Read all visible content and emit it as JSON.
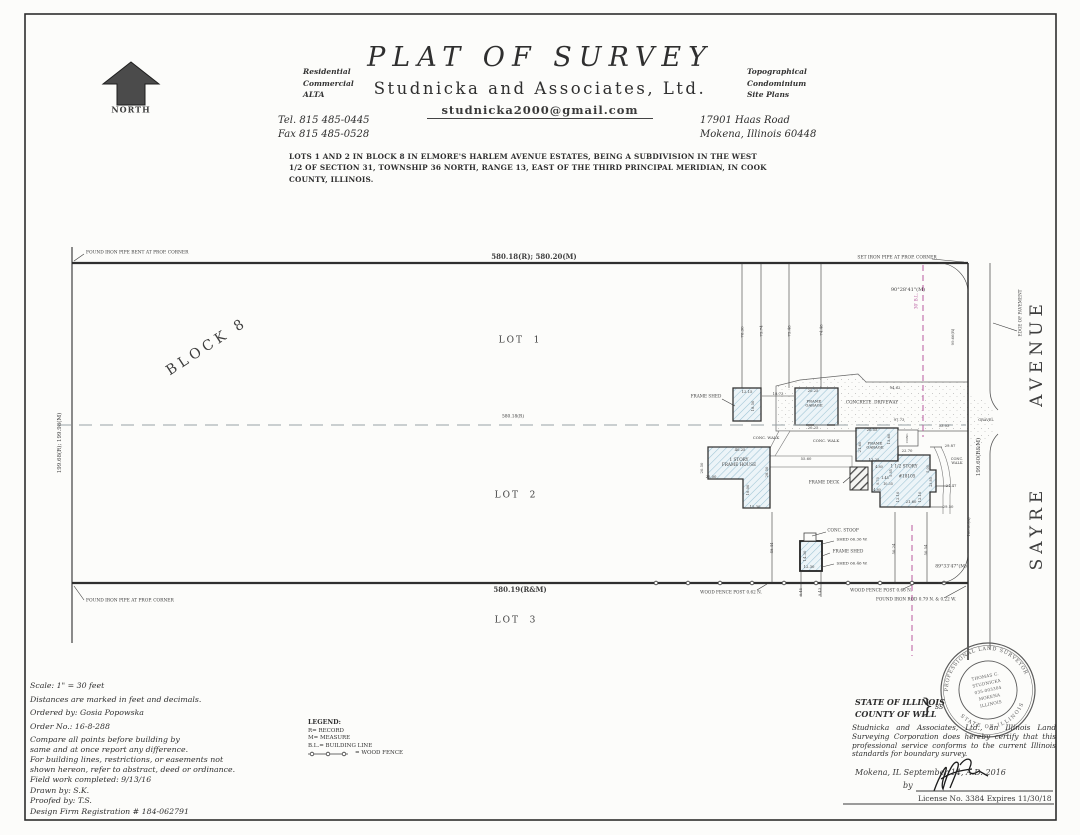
{
  "colors": {
    "ink": "#3a3a3a",
    "building_line_pink": "#b8599f",
    "hatch_blue": "#9dc3d4",
    "paper": "#fcfcfa"
  },
  "header": {
    "title": "PLAT  OF  SURVEY",
    "company": "Studnicka  and  Associates,  Ltd.",
    "email": "studnicka2000@gmail.com",
    "services_left": [
      "Residential",
      "Commercial",
      "ALTA"
    ],
    "services_right": [
      "Topographical",
      "Condominium",
      "Site Plans"
    ],
    "tel": "Tel. 815 485-0445",
    "fax": "Fax 815 485-0528",
    "address_line1": "17901 Haas Road",
    "address_line2": "Mokena, Illinois 60448",
    "legal_description": "LOTS 1 AND 2 IN BLOCK 8 IN ELMORE'S HARLEM AVENUE ESTATES, BEING A SUBDIVISION IN THE WEST 1/2 OF SECTION 31, TOWNSHIP 36 NORTH, RANGE 13, EAST OF THE THIRD PRINCIPAL MERIDIAN, IN COOK COUNTY, ILLINOIS."
  },
  "drawing": {
    "labels": [
      {
        "n": "north-label",
        "t": "NORTH",
        "x": 131,
        "y": 110,
        "s": 8,
        "b": 1,
        "ls": 1
      },
      {
        "n": "found-iron-pipe-bent-note",
        "t": "FOUND IRON PIPE BENT AT PROP. CORNER",
        "x": 86,
        "y": 253,
        "s": 4.4,
        "a": "l"
      },
      {
        "n": "dim-top-boundary",
        "t": "580.18(R); 580.20(M)",
        "x": 534,
        "y": 257,
        "s": 7,
        "b": 1
      },
      {
        "n": "set-iron-pipe-note",
        "t": "SET IRON PIPE AT PROP. CORNER",
        "x": 897,
        "y": 258,
        "s": 4.4
      },
      {
        "n": "angle-northeast",
        "t": "90°28'41\"(M)",
        "x": 908,
        "y": 291,
        "s": 5
      },
      {
        "n": "building-line-label",
        "t": "30' B.L.",
        "x": 917,
        "y": 301,
        "r": -90,
        "s": 4.2,
        "c": "#b8599f"
      },
      {
        "n": "edge-of-pavement-label",
        "t": "EDGE OF PAVEMENT",
        "x": 1021,
        "y": 313,
        "r": -90,
        "s": 4.2
      },
      {
        "n": "street-avenue",
        "t": "AVENUE",
        "x": 1037,
        "y": 353,
        "r": -90,
        "s": 17,
        "ls": 5
      },
      {
        "n": "street-sayre",
        "t": "SAYRE",
        "x": 1037,
        "y": 528,
        "r": -90,
        "s": 17,
        "ls": 5
      },
      {
        "n": "block-8",
        "t": "BLOCK 8",
        "x": 207,
        "y": 347,
        "r": -33,
        "s": 14,
        "ls": 4
      },
      {
        "n": "lot-1",
        "t": "LOT  1",
        "x": 520,
        "y": 341,
        "s": 9,
        "ls": 2
      },
      {
        "n": "dim-center-line",
        "t": "580.18(R)",
        "x": 513,
        "y": 417,
        "s": 4.4
      },
      {
        "n": "lot-2",
        "t": "LOT  2",
        "x": 516,
        "y": 496,
        "s": 9,
        "ls": 2
      },
      {
        "n": "dim-bottom-boundary",
        "t": "580.19(R&M)",
        "x": 520,
        "y": 590,
        "s": 7,
        "b": 1
      },
      {
        "n": "lot-3",
        "t": "LOT  3",
        "x": 516,
        "y": 621,
        "s": 9,
        "ls": 2
      },
      {
        "n": "found-iron-pipe-note",
        "t": "FOUND IRON PIPE AT PROP. CORNER",
        "x": 86,
        "y": 601,
        "s": 4.4,
        "a": "l"
      },
      {
        "n": "dim-west-boundary",
        "t": "199.68(R); 199.98(M)",
        "x": 60,
        "y": 443,
        "r": -90,
        "s": 5.5
      },
      {
        "n": "dim-east-boundary",
        "t": "199.60(R&M)",
        "x": 979,
        "y": 457,
        "r": -90,
        "s": 5.5
      },
      {
        "n": "dim-9966",
        "t": "99.66(R)",
        "x": 953,
        "y": 337,
        "r": -90,
        "s": 3.8
      },
      {
        "n": "dim-10000",
        "t": "100.00(R)",
        "x": 969,
        "y": 527,
        "r": -90,
        "s": 3.8
      },
      {
        "n": "gravel-label",
        "t": "GRAVEL",
        "x": 986,
        "y": 420,
        "s": 3.6
      },
      {
        "n": "dim-7830",
        "t": "78.30",
        "x": 743,
        "y": 332,
        "r": -90,
        "s": 4
      },
      {
        "n": "dim-7574",
        "t": "75.74",
        "x": 762,
        "y": 331,
        "r": -90,
        "s": 4
      },
      {
        "n": "dim-7548",
        "t": "75.48",
        "x": 790,
        "y": 331,
        "r": -90,
        "s": 4
      },
      {
        "n": "dim-7448",
        "t": "74.48",
        "x": 822,
        "y": 330,
        "r": -90,
        "s": 4
      },
      {
        "n": "frame-shed-1-label",
        "t": "FRAME SHED",
        "x": 706,
        "y": 397,
        "s": 4.2
      },
      {
        "n": "dim-1215",
        "t": "12.15",
        "x": 747,
        "y": 392,
        "s": 3.8
      },
      {
        "n": "dim-1850",
        "t": "18.50",
        "x": 753,
        "y": 406,
        "r": -90,
        "s": 3.8
      },
      {
        "n": "dim-1873",
        "t": "18.73",
        "x": 778,
        "y": 394,
        "s": 3.8
      },
      {
        "n": "frame-garage-1-label",
        "t": "FRAME\nGARAGE",
        "x": 814,
        "y": 404,
        "s": 3.8
      },
      {
        "n": "dim-2025-top",
        "t": "20.25",
        "x": 813,
        "y": 391,
        "s": 3.8
      },
      {
        "n": "dim-2025-bottom",
        "t": "20.25",
        "x": 813,
        "y": 428,
        "s": 3.8
      },
      {
        "n": "concrete-driveway-label",
        "t": "CONCRETE  DRIVEWAY",
        "x": 872,
        "y": 403,
        "s": 4.2
      },
      {
        "n": "dim-9462",
        "t": "94.62",
        "x": 895,
        "y": 388,
        "s": 3.8
      },
      {
        "n": "dim-9773",
        "t": "97.73",
        "x": 899,
        "y": 420,
        "s": 3.8
      },
      {
        "n": "dim-5303",
        "t": "53.03",
        "x": 944,
        "y": 426,
        "s": 3.8
      },
      {
        "n": "conc-walk-1-label",
        "t": "CONC. WALK",
        "x": 766,
        "y": 438,
        "s": 3.8
      },
      {
        "n": "conc-walk-2-label",
        "t": "CONC. WALK",
        "x": 826,
        "y": 441,
        "s": 3.8
      },
      {
        "n": "house-label",
        "t": "1 STORY\nFRAME HOUSE",
        "x": 739,
        "y": 463,
        "s": 4.2
      },
      {
        "n": "dim-4025",
        "t": "40.25",
        "x": 740,
        "y": 450,
        "s": 3.8
      },
      {
        "n": "dim-2050",
        "t": "20.50",
        "x": 702,
        "y": 468,
        "r": -90,
        "s": 3.8
      },
      {
        "n": "dim-2500",
        "t": "25.00",
        "x": 711,
        "y": 477,
        "s": 3.8
      },
      {
        "n": "dim-2850",
        "t": "28.50",
        "x": 767,
        "y": 472,
        "r": -90,
        "s": 3.8
      },
      {
        "n": "dim-1800",
        "t": "18.00",
        "x": 748,
        "y": 490,
        "r": -90,
        "s": 3.8
      },
      {
        "n": "dim-1530",
        "t": "15.30",
        "x": 755,
        "y": 507,
        "s": 3.8
      },
      {
        "n": "dim-5560",
        "t": "55.60",
        "x": 806,
        "y": 459,
        "s": 3.8
      },
      {
        "n": "frame-garage-2-label",
        "t": "FRAME\nGARAGE",
        "x": 875,
        "y": 446,
        "s": 3.8
      },
      {
        "n": "dim-2655",
        "t": "26.55",
        "x": 872,
        "y": 430,
        "s": 3.8
      },
      {
        "n": "dim-2160-garage",
        "t": "21.60",
        "x": 860,
        "y": 447,
        "r": -90,
        "s": 3.8
      },
      {
        "n": "dim-1360",
        "t": "13.60",
        "x": 889,
        "y": 439,
        "r": -90,
        "s": 3.8
      },
      {
        "n": "dim-1325",
        "t": "13.25",
        "x": 874,
        "y": 460,
        "s": 3.8
      },
      {
        "n": "conc-box-label",
        "t": "CONC.",
        "x": 908,
        "y": 438,
        "r": -90,
        "s": 3
      },
      {
        "n": "dim-2270",
        "t": "22.70",
        "x": 907,
        "y": 451,
        "s": 3.8
      },
      {
        "n": "story-label",
        "t": "1 1/2 STORY",
        "x": 904,
        "y": 467,
        "s": 4.2
      },
      {
        "n": "house-number",
        "t": "#18105",
        "x": 907,
        "y": 477,
        "s": 4.2
      },
      {
        "n": "dim-480-upper",
        "t": "4.80",
        "x": 879,
        "y": 467,
        "s": 3.4
      },
      {
        "n": "dim-585",
        "t": "5.85",
        "x": 891,
        "y": 473,
        "r": -90,
        "s": 3.4
      },
      {
        "n": "dim-145",
        "t": "1.45",
        "x": 885,
        "y": 478,
        "s": 3.4
      },
      {
        "n": "dim-870",
        "t": "8.70",
        "x": 878,
        "y": 481,
        "r": -90,
        "s": 3.4
      },
      {
        "n": "dim-1035",
        "t": "10.35",
        "x": 888,
        "y": 484,
        "s": 3.4
      },
      {
        "n": "dim-480-lower",
        "t": "4.80",
        "x": 877,
        "y": 490,
        "s": 3.4
      },
      {
        "n": "dim-1210-left",
        "t": "12.10",
        "x": 898,
        "y": 497,
        "r": -90,
        "s": 3.8
      },
      {
        "n": "dim-2160-story",
        "t": "21.60",
        "x": 911,
        "y": 502,
        "s": 3.8
      },
      {
        "n": "dim-1210-right",
        "t": "12.10",
        "x": 920,
        "y": 497,
        "r": -90,
        "s": 3.8
      },
      {
        "n": "dim-500",
        "t": "5.00",
        "x": 928,
        "y": 469,
        "r": -90,
        "s": 3.4
      },
      {
        "n": "dim-2385",
        "t": "23.85",
        "x": 931,
        "y": 482,
        "r": -90,
        "s": 3.4
      },
      {
        "n": "dim-2447",
        "t": "24.47",
        "x": 951,
        "y": 486,
        "s": 3.8
      },
      {
        "n": "dim-2950",
        "t": "29.50",
        "x": 948,
        "y": 507,
        "s": 3.8
      },
      {
        "n": "dim-2987",
        "t": "29.87",
        "x": 950,
        "y": 446,
        "s": 3.8
      },
      {
        "n": "conc-walk-3-label",
        "t": "CONC.\nWALK",
        "x": 957,
        "y": 461,
        "s": 3.6
      },
      {
        "n": "frame-deck-label",
        "t": "FRAME DECK",
        "x": 824,
        "y": 483,
        "s": 4.2
      },
      {
        "n": "conc-stoop-label",
        "t": "CONC. STOOP",
        "x": 843,
        "y": 531,
        "s": 4.2
      },
      {
        "n": "shed-corner-1",
        "t": "SHED 66.36 W.",
        "x": 852,
        "y": 540,
        "s": 4
      },
      {
        "n": "frame-shed-2-label",
        "t": "FRAME SHED",
        "x": 848,
        "y": 552,
        "s": 4.2
      },
      {
        "n": "shed-corner-2",
        "t": "SHED 66.46 W.",
        "x": 852,
        "y": 564,
        "s": 4
      },
      {
        "n": "dim-1430",
        "t": "14.30",
        "x": 805,
        "y": 556,
        "r": -90,
        "s": 3.8
      },
      {
        "n": "dim-1230",
        "t": "12.30",
        "x": 809,
        "y": 567,
        "s": 3.8
      },
      {
        "n": "dim-945",
        "t": "9.45",
        "x": 801,
        "y": 592,
        "r": -90,
        "s": 3.6
      },
      {
        "n": "dim-943",
        "t": "9.43",
        "x": 820,
        "y": 592,
        "r": -90,
        "s": 3.6
      },
      {
        "n": "dim-4844",
        "t": "48.44",
        "x": 772,
        "y": 548,
        "r": -90,
        "s": 3.8
      },
      {
        "n": "dim-5024",
        "t": "50.24",
        "x": 894,
        "y": 549,
        "r": -90,
        "s": 3.8
      },
      {
        "n": "dim-5054",
        "t": "50.54",
        "x": 926,
        "y": 550,
        "r": -90,
        "s": 3.8
      },
      {
        "n": "wood-fence-post-1",
        "t": "WOOD FENCE POST 0.62 N.",
        "x": 731,
        "y": 593,
        "s": 4.2
      },
      {
        "n": "wood-fence-post-2",
        "t": "WOOD FENCE POST 0.66 N.",
        "x": 881,
        "y": 591,
        "s": 4.2
      },
      {
        "n": "found-iron-rod",
        "t": "FOUND IRON ROD 0.79 N. & 0.22 W.",
        "x": 916,
        "y": 600,
        "s": 4.2
      },
      {
        "n": "angle-southeast",
        "t": "89°33'47\"(M)",
        "x": 951,
        "y": 567,
        "s": 4.6
      }
    ]
  },
  "notes": {
    "lines": [
      "Scale: 1\" =  30  feet",
      "Distances are marked in feet and decimals.",
      "Ordered by:  Gosia Popowska",
      "Order No.:  16-8-288",
      "Compare all points before building by",
      "same and at once report any difference.",
      "For building lines, restrictions, or easements not",
      "shown hereon, refer to abstract, deed or ordinance.",
      "Field work completed: 9/13/16",
      "Drawn by:  S.K.",
      "Proofed by:  T.S.",
      "Design Firm Registration # 184-062791"
    ]
  },
  "legend": {
    "title": "LEGEND:",
    "items": [
      "R= RECORD",
      "M= MEASURE",
      "B.L.= BUILDING LINE"
    ],
    "fence_label": "= WOOD FENCE"
  },
  "cert": {
    "state": "STATE OF ILLINOIS",
    "county": "COUNTY OF WILL",
    "brace": "}",
    "ss": "ss",
    "body": "Studnicka and Associates, Ltd., an Illinois Land Surveying Corporation does hereby certify that this professional service conforms to the current Illinois standards for boundary survey.",
    "place_date": "Mokena, IL September 14, A.D. 2016",
    "by": "by",
    "license": "License No. 3384 Expires 11/30/18"
  },
  "seal": {
    "arc_top": "PROFESSIONAL LAND SURVEYOR",
    "arc_bottom": "STATE OF ILLINOIS",
    "center": [
      "THOMAS C.",
      "STUDNICKA",
      "035-003304",
      "MOKENA",
      "ILLINOIS"
    ]
  }
}
